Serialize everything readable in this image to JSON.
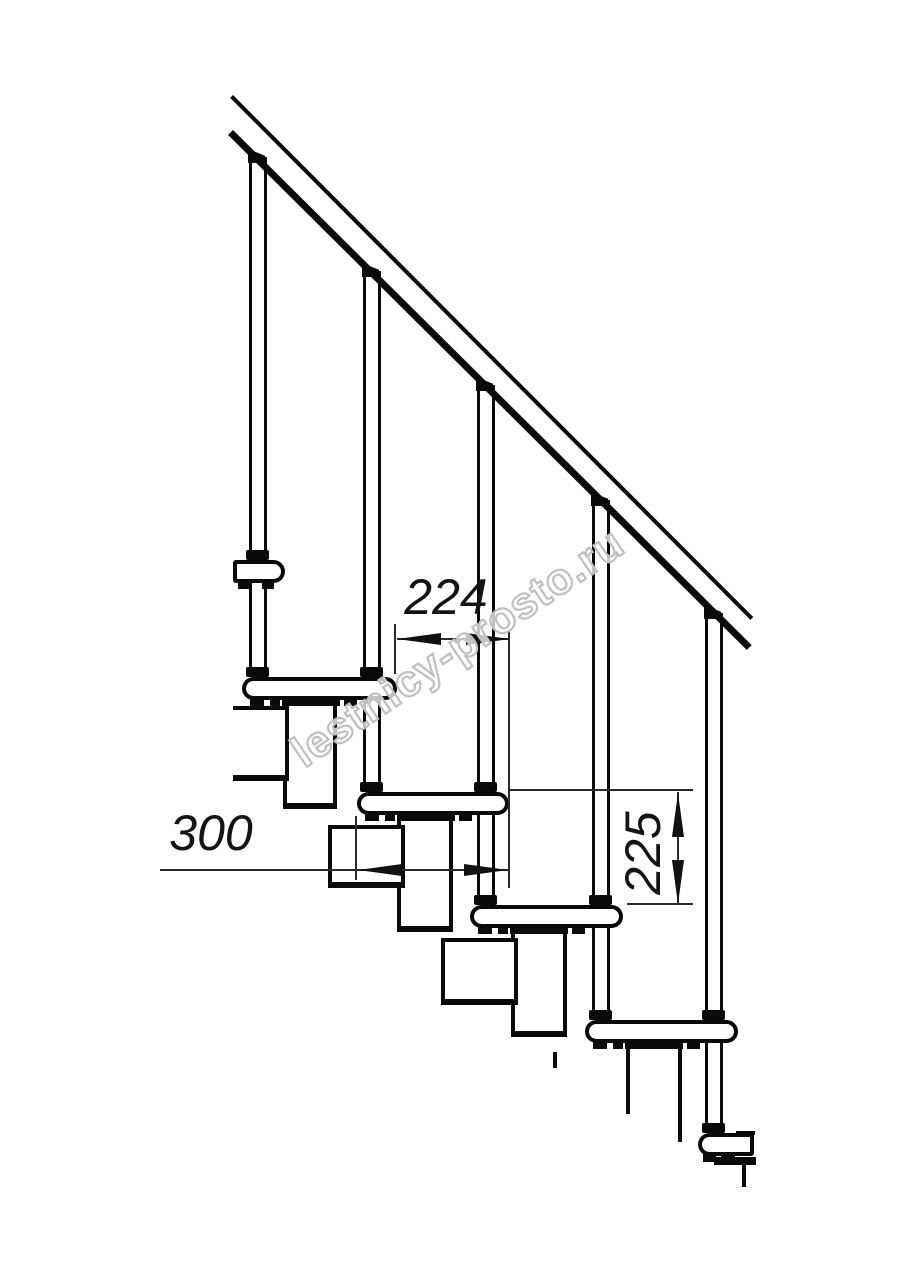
{
  "watermark": {
    "text": "lestnicy-prosto.ru"
  },
  "dimensions": {
    "step_offset": {
      "label": "224",
      "orientation": "horizontal",
      "meaning": "tread horizontal offset, mm"
    },
    "step_depth": {
      "label": "300",
      "orientation": "horizontal",
      "meaning": "tread depth, mm"
    },
    "riser_height": {
      "label": "225",
      "orientation": "vertical",
      "meaning": "riser height, mm"
    }
  },
  "colors": {
    "line": "#0a0a0a",
    "dim_line": "#2b2b2b",
    "watermark_stroke": "#c0c0c0",
    "background": "#ffffff"
  },
  "drawing": {
    "type": "modular-staircase-side-view",
    "handrail": {
      "upper": {
        "x": 233,
        "y": 95,
        "len": 737,
        "th": 4,
        "angle": 45.1
      },
      "lower": {
        "x": 233,
        "y": 130,
        "len": 731,
        "th": 7,
        "angle": 44.8
      }
    },
    "balusters": [
      {
        "x": 249,
        "capY": 149,
        "bottom": 677,
        "collars": [
          560,
          677
        ]
      },
      {
        "x": 363,
        "capY": 263,
        "bottom": 792,
        "collars": [
          677,
          792
        ]
      },
      {
        "x": 477,
        "capY": 377,
        "bottom": 905,
        "collars": [
          792,
          905
        ]
      },
      {
        "x": 592,
        "capY": 492,
        "bottom": 1020,
        "collars": [
          905,
          1020
        ]
      },
      {
        "x": 705,
        "capY": 605,
        "bottom": 1133,
        "collars": [
          1020,
          1133
        ]
      }
    ],
    "steps": [
      {
        "x": 233,
        "y": 560,
        "w": 52,
        "cut": "left",
        "feet": [
          [
            5,
            13
          ],
          [
            29,
            12
          ]
        ]
      },
      {
        "x": 242,
        "y": 677,
        "w": 155,
        "cut": "",
        "feet": [
          [
            8,
            14
          ],
          [
            28,
            10
          ],
          [
            102,
            13
          ]
        ],
        "plate": [
          40,
          58
        ]
      },
      {
        "x": 357,
        "y": 792,
        "w": 152,
        "cut": "",
        "feet": [
          [
            8,
            14
          ],
          [
            28,
            10
          ],
          [
            102,
            13
          ]
        ],
        "plate": [
          40,
          58
        ]
      },
      {
        "x": 470,
        "y": 905,
        "w": 153,
        "cut": "",
        "feet": [
          [
            8,
            14
          ],
          [
            28,
            10
          ],
          [
            102,
            13
          ]
        ],
        "plate": [
          40,
          58
        ]
      },
      {
        "x": 585,
        "y": 1020,
        "w": 153,
        "cut": "",
        "feet": [
          [
            8,
            14
          ],
          [
            28,
            10
          ],
          [
            102,
            13
          ]
        ],
        "plate": [
          40,
          58
        ]
      },
      {
        "x": 698,
        "y": 1133,
        "w": 56,
        "cut": "right",
        "feet": [
          [
            5,
            13
          ],
          [
            23,
            14
          ]
        ]
      }
    ],
    "modules": {
      "boxes": [
        {
          "x": 283,
          "y": 697,
          "w": 54,
          "h": 112
        },
        {
          "x": 397,
          "y": 812,
          "w": 56,
          "h": 120
        },
        {
          "x": 511,
          "y": 925,
          "w": 56,
          "h": 112
        },
        {
          "x": 233,
          "y": 706,
          "w": 56,
          "h": 75,
          "openLeft": true
        },
        {
          "x": 328,
          "y": 825,
          "w": 77,
          "h": 63
        },
        {
          "x": 441,
          "y": 938,
          "w": 77,
          "h": 67
        }
      ],
      "lines": [
        {
          "x": 626,
          "y": 1044,
          "w": 4,
          "h": 70
        },
        {
          "x": 678,
          "y": 1044,
          "w": 4,
          "h": 98
        },
        {
          "x": 553,
          "y": 1052,
          "w": 4,
          "h": 16
        },
        {
          "x": 714,
          "y": 1157,
          "w": 42,
          "h": 8
        },
        {
          "x": 742,
          "y": 1164,
          "w": 4,
          "h": 23
        },
        {
          "x": 736,
          "y": 1131,
          "w": 19,
          "h": 4
        }
      ]
    }
  }
}
